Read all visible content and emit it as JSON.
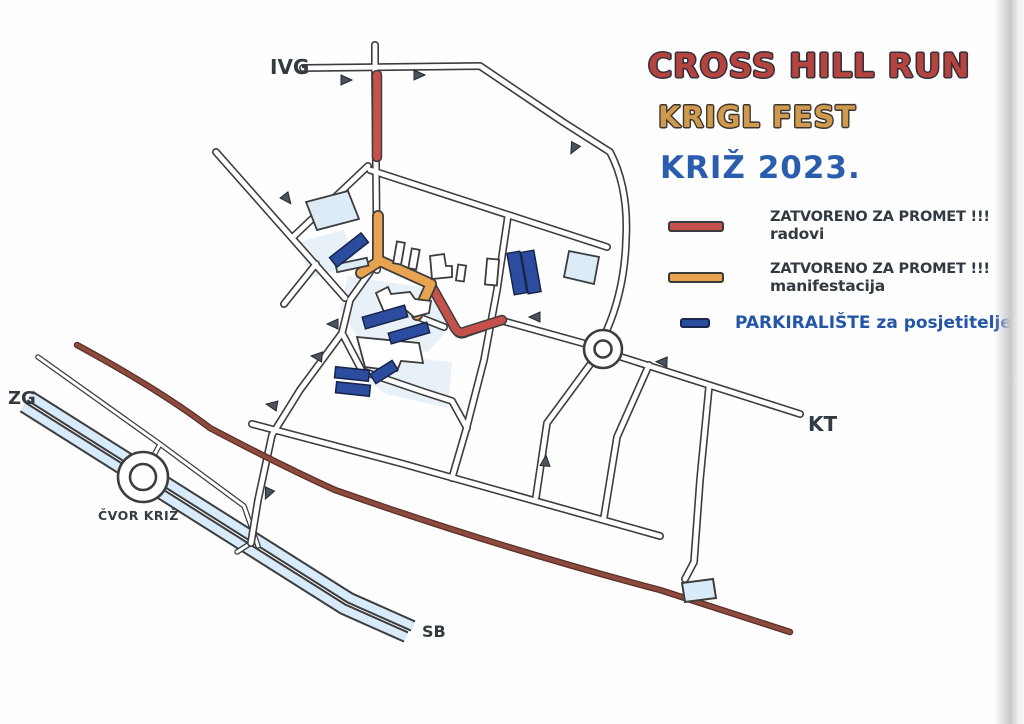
{
  "title": {
    "line1": "CROSS HILL RUN",
    "line2": "KRIGL FEST",
    "line3": "KRIŽ 2023."
  },
  "legend": [
    {
      "swatch": "closed-road-radovi",
      "line1": "ZATVORENO ZA PROMET !!!",
      "line2": "radovi"
    },
    {
      "swatch": "closed-road-manifestacija",
      "line1": "ZATVORENO ZA PROMET !!!",
      "line2": "manifestacija"
    },
    {
      "swatch": "parking",
      "line1": "PARKIRALIŠTE za posjetitelje"
    }
  ],
  "map_labels": {
    "ivg": "IVG",
    "zg": "ZG",
    "kt": "KT",
    "cvor_kriz": "ČVOR KRIŽ",
    "sb": "SB"
  },
  "colors": {
    "road_outline": "#3d3d3d",
    "road_fill": "#ffffff",
    "closed_radovi": "#c6504b",
    "closed_manifestacija": "#e8a351",
    "parking": "#2b4c9f",
    "parking_border": "#19244a",
    "motorway_fill": "#d8ebfa",
    "highway_closed_line": "#8d4b40",
    "block_fill": "#e9f1f8",
    "building_fill": "#dcebf6",
    "arrow": "#4b545c",
    "text_dark": "#333b42",
    "title_red": "#b5443f",
    "title_orange": "#cf9a4e",
    "title_blue": "#2b5dae",
    "legend_parking_text": "#2456a8"
  }
}
